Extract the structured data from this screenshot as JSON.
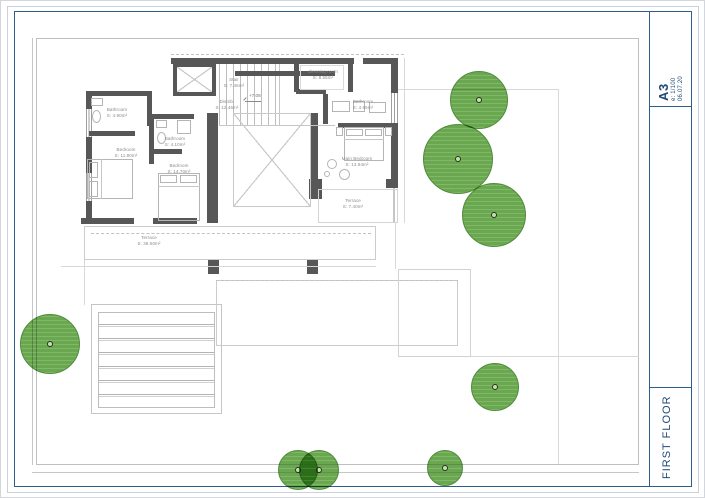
{
  "titleblock": {
    "format": "A3",
    "scale": "e: 1/100",
    "date": "06.07.20",
    "floor": "FIRST FLOOR"
  },
  "plan": {
    "level_mark": "+7.08",
    "rooms": [
      {
        "name": "Stair",
        "area": "S: 7.46m²"
      },
      {
        "name": "Distrib.",
        "area": "S: 12.46m²"
      },
      {
        "name": "dressing room",
        "area": "S: 8.55m²"
      },
      {
        "name": "Bathroom",
        "area": "S: 4.95m²"
      },
      {
        "name": "Main Bedroom",
        "area": "S: 13.94m²"
      },
      {
        "name": "Terrace",
        "area": "S: 7.40m²"
      },
      {
        "name": "Bathroom",
        "area": "S: 4.90m²"
      },
      {
        "name": "Bedroom",
        "area": "S: 11.80m²"
      },
      {
        "name": "Bathroom",
        "area": "S: 4.10m²"
      },
      {
        "name": "Bedroom",
        "area": "S: 14.70m²"
      },
      {
        "name": "Terrace",
        "area": "S: 38.60m²"
      }
    ]
  },
  "colors": {
    "frame_blue": "#2e5d8a",
    "title_text": "#1f4976",
    "wall_gray": "#575757",
    "site_line": "#c6c6c6",
    "label_text": "#8a8a8a",
    "tree_fill": "#6aa84f",
    "tree_stroke": "#4f8c3a"
  }
}
